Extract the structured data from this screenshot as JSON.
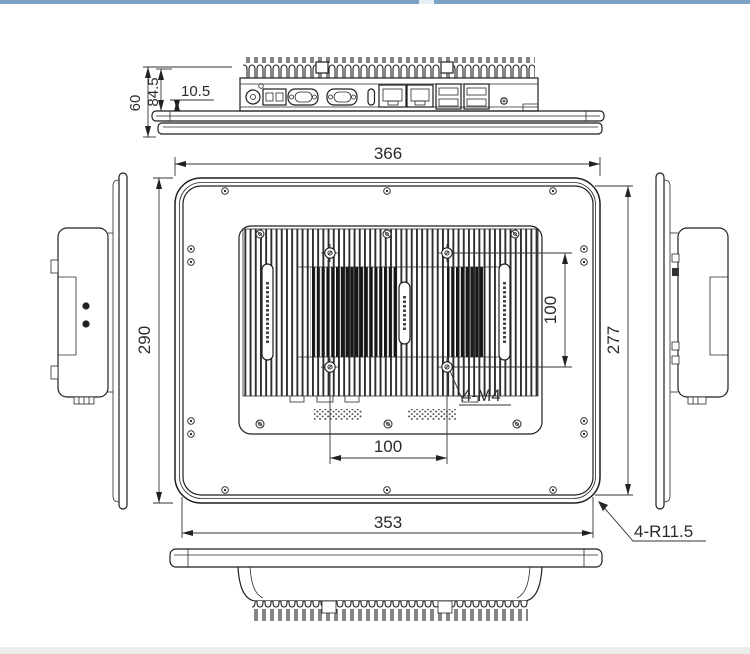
{
  "drawing": {
    "type": "technical-dimension-drawing",
    "subject": "industrial panel PC enclosure, five orthographic views",
    "colors": {
      "line": "#1f1f1f",
      "background": "#ffffff",
      "top_bar": "#7ba1c4",
      "bottom_bar": "#ededed"
    },
    "dims": {
      "outer_width": "366",
      "outer_height": "290",
      "panel_height": "277",
      "panel_width": "353",
      "vesa_vertical": "100",
      "vesa_horizontal": "100",
      "vesa_thread": "4-M4",
      "corner_radius": "4-R11.5",
      "depth_total": "60",
      "depth_body": "84.5",
      "bezel_gap": "10.5"
    }
  }
}
